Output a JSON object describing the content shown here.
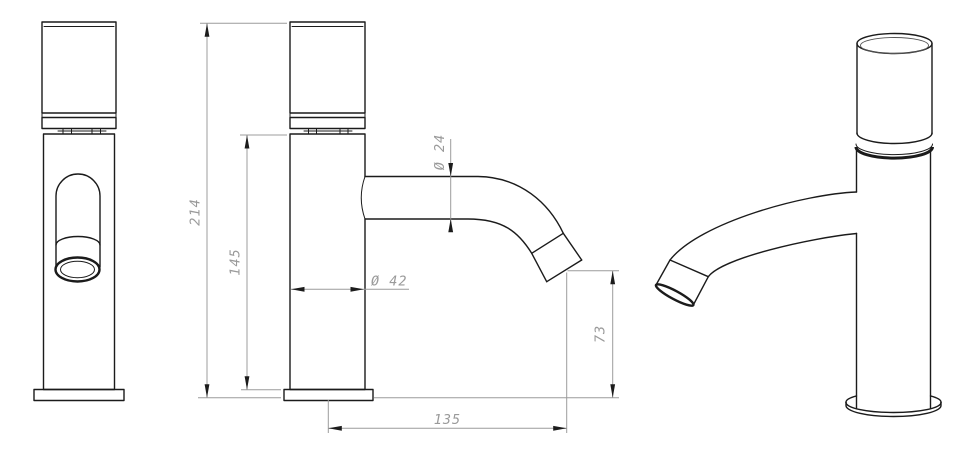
{
  "page": {
    "background": "#ffffff"
  },
  "drawing": {
    "type": "technical-dimension-drawing",
    "subject": "single-hole basin tap shown in front view, dimensioned side view and perspective view",
    "dimensions": {
      "total_height": "214",
      "body_height": "145",
      "spout_diameter": "Ø 24",
      "body_diameter": "Ø 42",
      "outlet_height": "73",
      "spout_reach": "135"
    },
    "colors": {
      "outline": "#1b1b1b",
      "dimension_line": "#9c9c9c",
      "dimension_text": "#9a9a9a",
      "arrowhead": "#1c1c1c",
      "background": "#ffffff"
    }
  }
}
